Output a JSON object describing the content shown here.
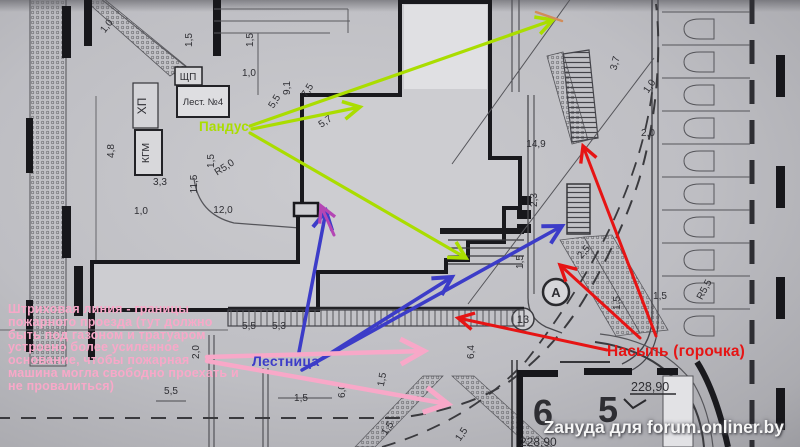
{
  "colors": {
    "green": "#aadd00",
    "blue": "#3c3cc8",
    "red": "#e61414",
    "pink": "#f8a8c8",
    "magenta": "#b446b4",
    "orange": "#d28c5a",
    "ink": "#3a3a3f"
  },
  "plan": {
    "texts": {
      "shp": "ЩП",
      "lest": "Лест. №4",
      "hp": "ХП",
      "kgm": "КГМ",
      "circle_a": "А",
      "circle_13": "13",
      "plot6": "6",
      "plot5": "5",
      "elev6": "228,90",
      "elev5": "228,90"
    },
    "dim_labels": [
      {
        "t": "1,0",
        "x": 109,
        "y": 28,
        "r": -52
      },
      {
        "t": "1,5",
        "x": 192,
        "y": 40,
        "r": -90
      },
      {
        "t": "1,5",
        "x": 253,
        "y": 40,
        "r": -90
      },
      {
        "t": "1,0",
        "x": 249,
        "y": 76,
        "r": 0
      },
      {
        "t": "9,1",
        "x": 290,
        "y": 88,
        "r": -90
      },
      {
        "t": "7,5",
        "x": 310,
        "y": 92,
        "r": -58
      },
      {
        "t": "5,5",
        "x": 277,
        "y": 103,
        "r": -58
      },
      {
        "t": "5,7",
        "x": 327,
        "y": 124,
        "r": -35
      },
      {
        "t": "1,5",
        "x": 214,
        "y": 161,
        "r": -90
      },
      {
        "t": "R5,0",
        "x": 226,
        "y": 170,
        "r": -33
      },
      {
        "t": "4,8",
        "x": 114,
        "y": 151,
        "r": -90
      },
      {
        "t": "3,3",
        "x": 160,
        "y": 185,
        "r": 0
      },
      {
        "t": "11,5",
        "x": 197,
        "y": 184,
        "r": -90
      },
      {
        "t": "1,0",
        "x": 141,
        "y": 214,
        "r": 0
      },
      {
        "t": "12,0",
        "x": 223,
        "y": 213,
        "r": 0
      },
      {
        "t": "2,3",
        "x": 537,
        "y": 200,
        "r": -90
      },
      {
        "t": "1,5",
        "x": 523,
        "y": 262,
        "r": -90
      },
      {
        "t": "14,9",
        "x": 536,
        "y": 147,
        "r": 0
      },
      {
        "t": "2,0",
        "x": 648,
        "y": 136,
        "r": 0
      },
      {
        "t": "3,7",
        "x": 618,
        "y": 64,
        "r": -75
      },
      {
        "t": "1,0",
        "x": 652,
        "y": 88,
        "r": -55
      },
      {
        "t": "1,5",
        "x": 620,
        "y": 303,
        "r": -90
      },
      {
        "t": "1,5",
        "x": 660,
        "y": 299,
        "r": 0
      },
      {
        "t": "R5,5",
        "x": 707,
        "y": 291,
        "r": -62
      },
      {
        "t": "2,5",
        "x": 586,
        "y": 254,
        "r": -48
      },
      {
        "t": "5,5",
        "x": 249,
        "y": 329,
        "r": 0
      },
      {
        "t": "5,3",
        "x": 279,
        "y": 329,
        "r": 0
      },
      {
        "t": "6,4",
        "x": 474,
        "y": 352,
        "r": -90
      },
      {
        "t": "6,0",
        "x": 345,
        "y": 391,
        "r": -90
      },
      {
        "t": "1,5",
        "x": 385,
        "y": 380,
        "r": -80
      },
      {
        "t": "1,5",
        "x": 301,
        "y": 401,
        "r": 0
      },
      {
        "t": "1,5",
        "x": 390,
        "y": 430,
        "r": -55
      },
      {
        "t": "1,5",
        "x": 464,
        "y": 436,
        "r": -55
      },
      {
        "t": "5,5",
        "x": 171,
        "y": 394,
        "r": 0
      },
      {
        "t": "2,0",
        "x": 199,
        "y": 352,
        "r": -90
      }
    ]
  },
  "annotations": {
    "pandus": {
      "label": "Пандус",
      "color": "green",
      "width": 3.2,
      "arrows": [
        [
          250,
          126,
          553,
          20
        ],
        [
          252,
          129,
          360,
          107
        ],
        [
          250,
          133,
          466,
          258
        ]
      ]
    },
    "lestnica": {
      "label": "Лестница",
      "color": "blue",
      "width": 3.5,
      "arrows": [
        [
          299,
          352,
          326,
          211
        ],
        [
          310,
          366,
          452,
          277
        ],
        [
          302,
          370,
          562,
          226
        ]
      ]
    },
    "nasyp": {
      "label": "Насыпь (горочка)",
      "color": "red",
      "width": 3,
      "arrows": [
        [
          656,
          336,
          583,
          146
        ],
        [
          640,
          338,
          560,
          265
        ],
        [
          607,
          350,
          458,
          318
        ]
      ]
    },
    "pink_note": {
      "color": "pink",
      "width": 4.5,
      "lines": [
        "Штриховая линия - границы",
        "пожарного проезда (тут должно",
        "быть под газоном и тратуаром",
        "устроено более усиленное",
        "основание, чтобы пожарная",
        "машина могла свободно проехать и",
        "не провалиться)"
      ],
      "arrows": [
        [
          207,
          357,
          424,
          351
        ],
        [
          207,
          361,
          448,
          404
        ]
      ]
    },
    "magenta_tip": {
      "color": "magenta",
      "width": 3,
      "arrows": [
        [
          334,
          235,
          321,
          206
        ]
      ]
    },
    "orange_mark": {
      "color": "orange",
      "width": 2.5,
      "arrows": [
        [
          536,
          12,
          562,
          21
        ]
      ],
      "no_head": true
    },
    "watermark": "Zануда для forum.onliner.by"
  }
}
